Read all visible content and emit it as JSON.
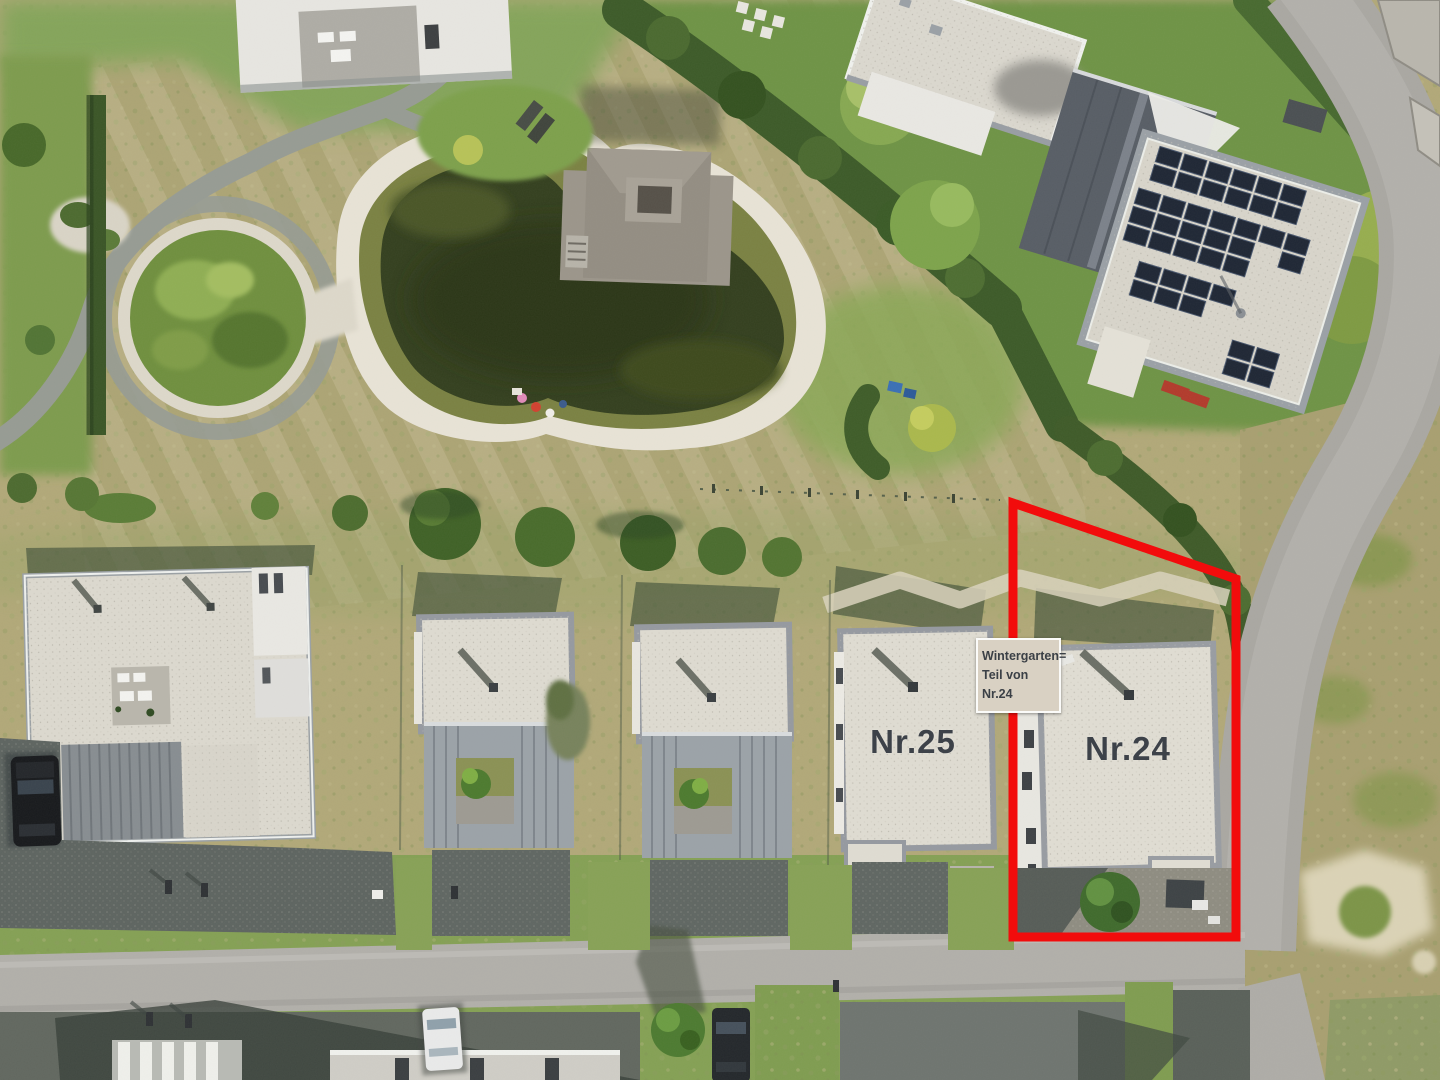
{
  "annotations": {
    "house_25_label": "Nr.25",
    "house_24_label": "Nr.24",
    "wintergarten_label_line1": "Wintergarten=",
    "wintergarten_label_line2": "Teil von Nr.24"
  },
  "colors": {
    "boundary_red": "#f20c0c",
    "roof_label_text": "#3d4249",
    "wintergarten_box_background": "#d9d1c3",
    "wintergarten_box_border": "#fbfbf9"
  }
}
